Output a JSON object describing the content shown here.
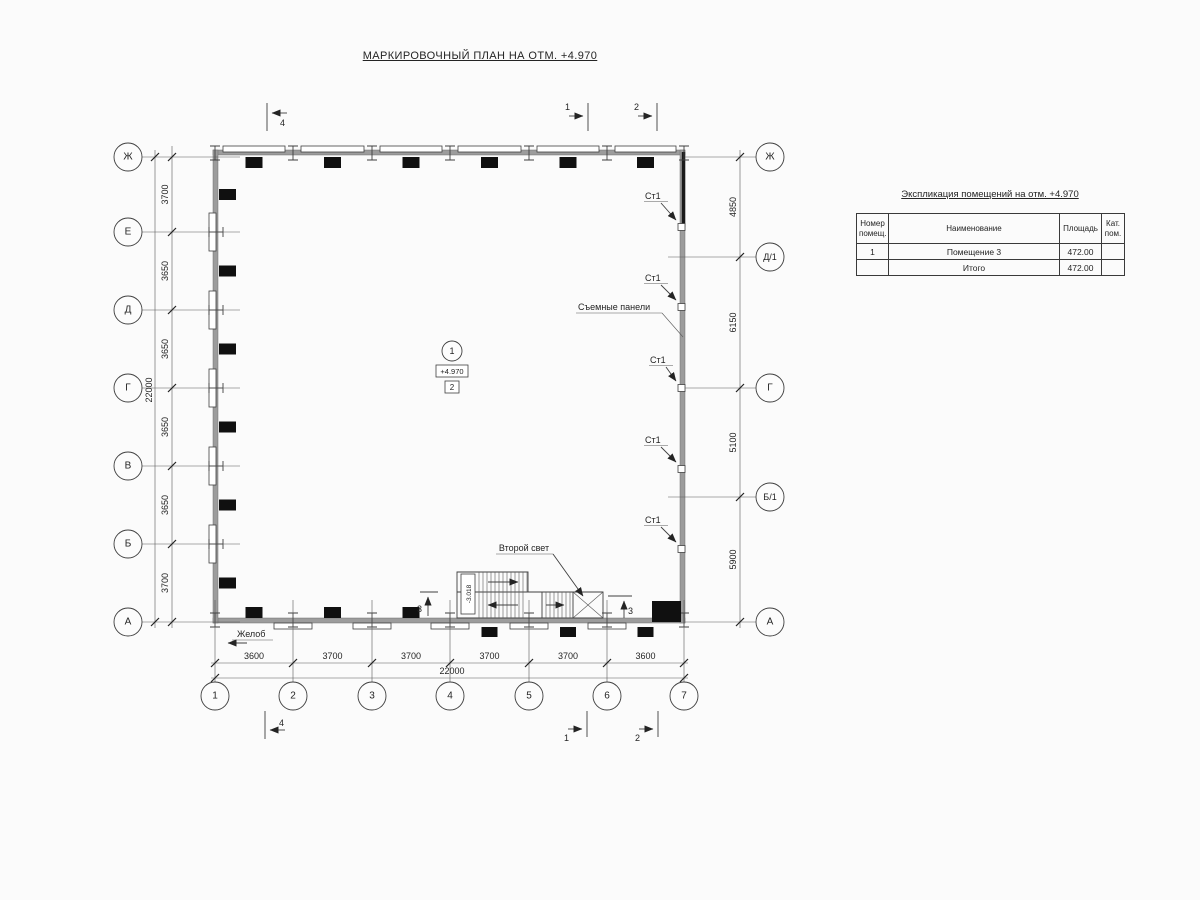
{
  "page": {
    "title": "МАРКИРОВОЧНЫЙ ПЛАН НА ОТМ. +4.970"
  },
  "plan": {
    "axes_left": [
      "Ж",
      "Е",
      "Д",
      "Г",
      "В",
      "Б",
      "А"
    ],
    "axes_right": [
      "Ж",
      "Д/1",
      "Г",
      "Б/1",
      "А"
    ],
    "axes_bottom": [
      "1",
      "2",
      "3",
      "4",
      "5",
      "6",
      "7"
    ],
    "dims_left": [
      "3700",
      "3650",
      "3650",
      "3650",
      "3650",
      "3700"
    ],
    "dim_left_total": "22000",
    "dims_right": [
      "4850",
      "6150",
      "5100",
      "5900"
    ],
    "dims_bottom": [
      "3600",
      "3700",
      "3700",
      "3700",
      "3700",
      "3600"
    ],
    "dim_bottom_total": "22000",
    "labels": {
      "st1": "Ст1",
      "removable_panels": "Съемные панели",
      "second_light": "Второй свет",
      "gutter": "Желоб",
      "room_number": "1",
      "elevation": "+4.970",
      "zone": "2",
      "stair_elevation": "-3.018"
    },
    "sections": {
      "s1": "1",
      "s2": "2",
      "s3": "3",
      "s4": "4"
    }
  },
  "table": {
    "title": "Экспликация помещений на отм. +4.970",
    "headers": [
      "Номер помещ.",
      "Наименование",
      "Площадь",
      "Кат. пом."
    ],
    "rows": [
      {
        "num": "1",
        "name": "Помещение 3",
        "area": "472.00",
        "cat": ""
      }
    ],
    "total_label": "Итого",
    "total_area": "472.00"
  }
}
